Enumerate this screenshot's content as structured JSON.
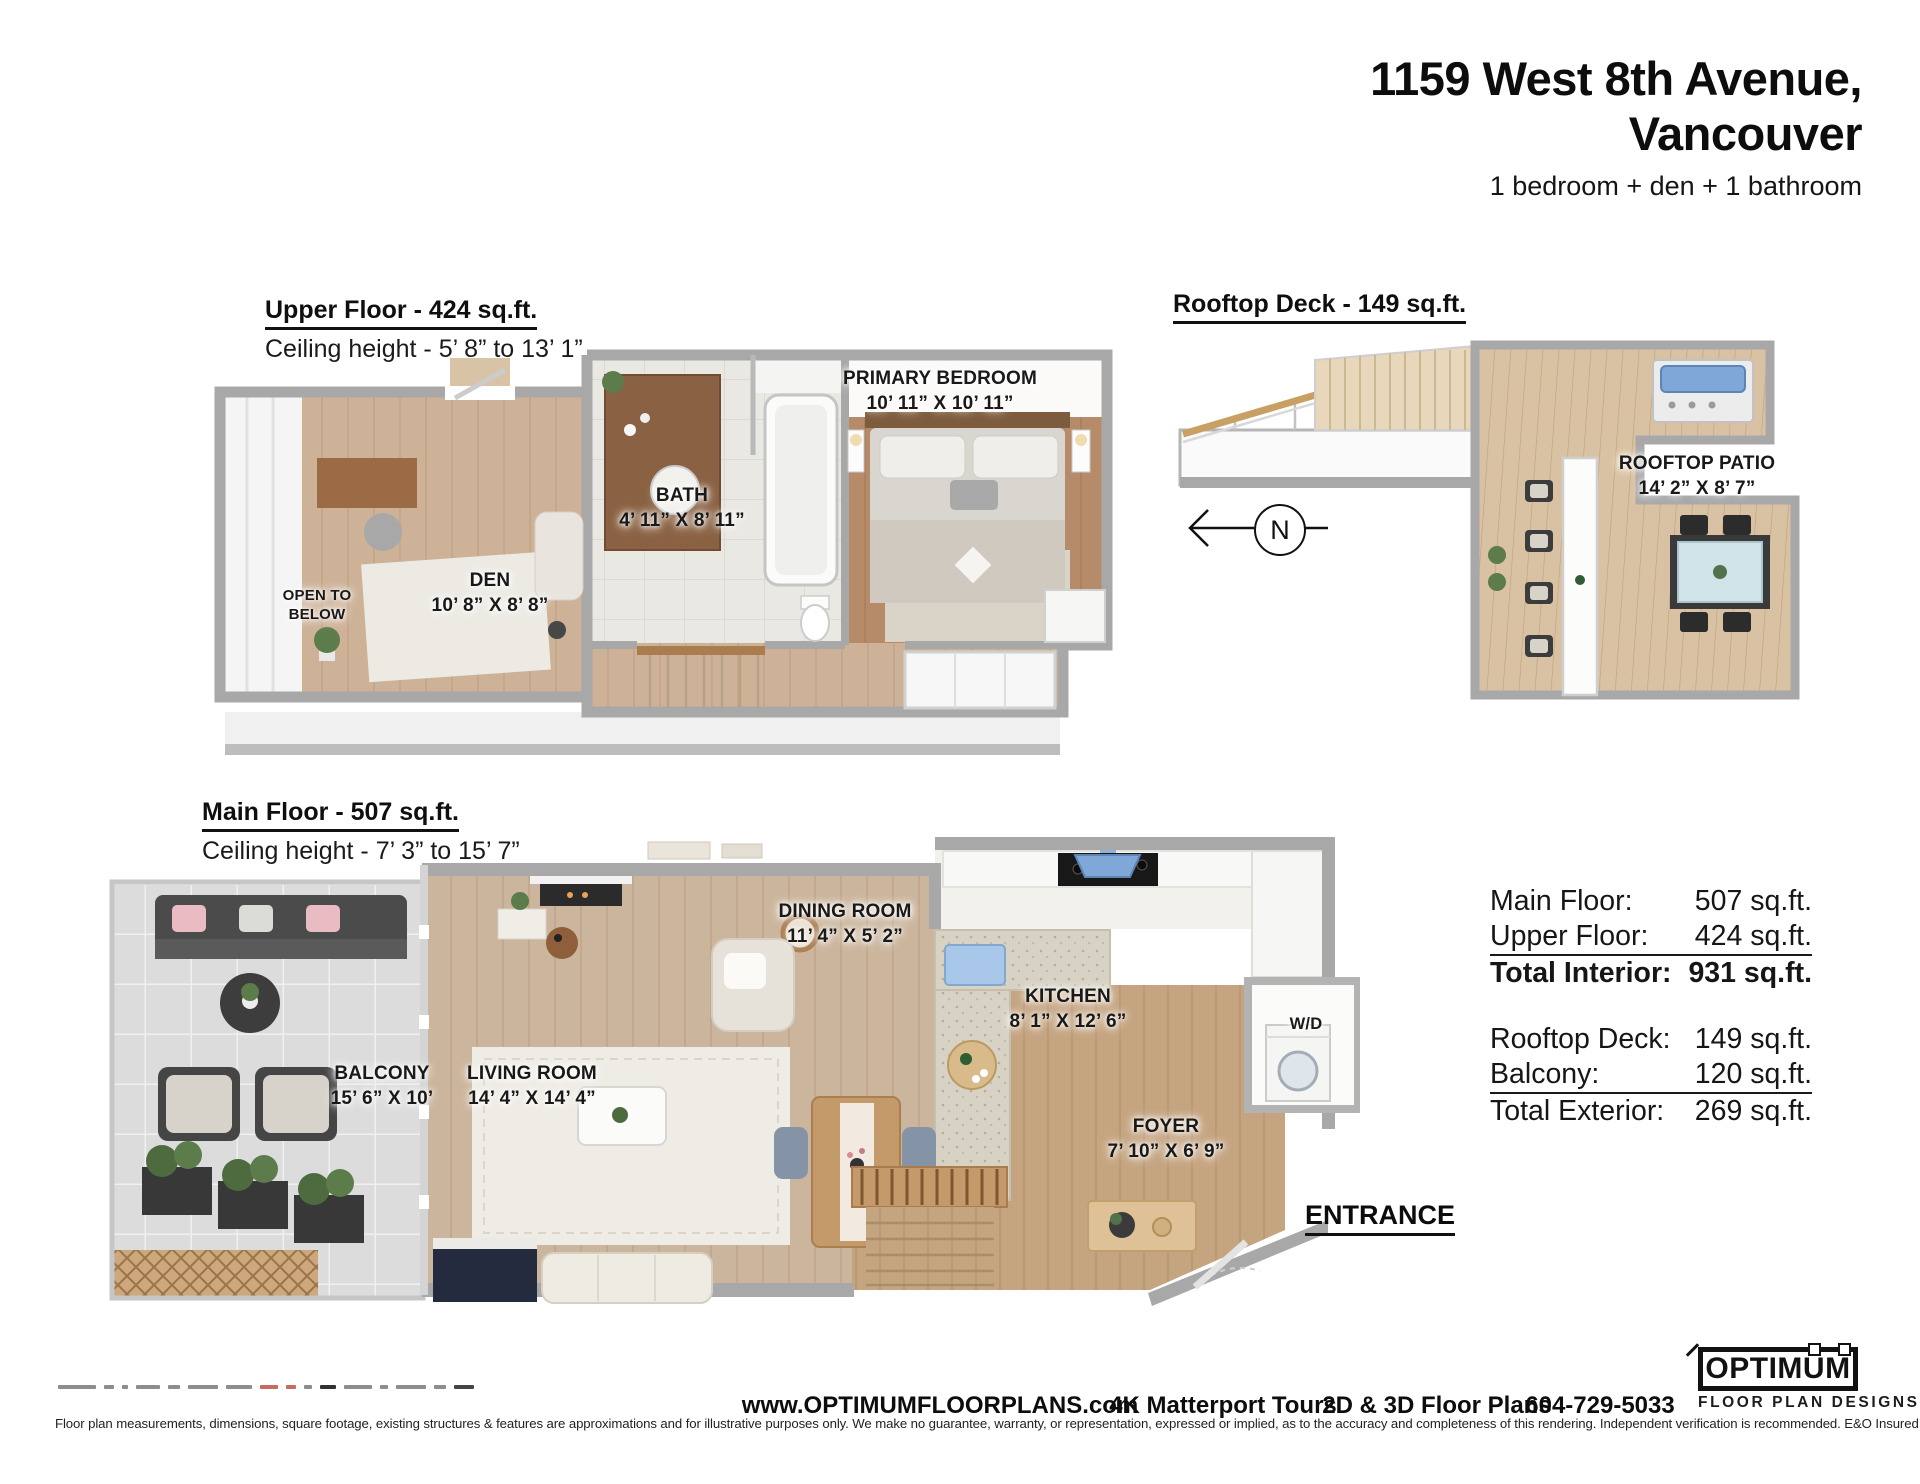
{
  "header": {
    "title_line1": "1159 West 8th Avenue,",
    "title_line2": "Vancouver",
    "subtitle": "1 bedroom + den + 1 bathroom"
  },
  "upper_floor": {
    "heading": "Upper Floor - 424 sq.ft.",
    "ceiling": "Ceiling height - 5’ 8” to 13’ 1”",
    "rooms": {
      "primary_bedroom": {
        "name": "PRIMARY BEDROOM",
        "dims": "10’ 11” X 10’ 11”"
      },
      "bath": {
        "name": "BATH",
        "dims": "4’ 11” X 8’ 11”"
      },
      "den": {
        "name": "DEN",
        "dims": "10’ 8” X 8’ 8”"
      },
      "open_to_below": "OPEN TO BELOW"
    }
  },
  "rooftop": {
    "heading": "Rooftop Deck - 149 sq.ft.",
    "patio": {
      "name": "ROOFTOP PATIO",
      "dims": "14’ 2” X 8’ 7”"
    },
    "compass_letter": "N"
  },
  "main_floor": {
    "heading": "Main Floor - 507 sq.ft.",
    "ceiling": "Ceiling height - 7’ 3” to 15’ 7”",
    "rooms": {
      "dining": {
        "name": "DINING ROOM",
        "dims": "11’ 4” X 5’ 2”"
      },
      "kitchen": {
        "name": "KITCHEN",
        "dims": "8’ 1” X 12’ 6”"
      },
      "balcony": {
        "name": "BALCONY",
        "dims": "15’ 6” X 10’"
      },
      "living": {
        "name": "LIVING ROOM",
        "dims": "14’ 4” X 14’ 4”"
      },
      "foyer": {
        "name": "FOYER",
        "dims": "7’ 10” X 6’ 9”"
      },
      "wd": "W/D"
    },
    "entrance": "ENTRANCE"
  },
  "summary": {
    "interior": [
      {
        "label": "Main Floor:",
        "value": "507 sq.ft."
      },
      {
        "label": "Upper Floor:",
        "value": "424 sq.ft."
      },
      {
        "label": "Total Interior:",
        "value": "931 sq.ft."
      }
    ],
    "exterior": [
      {
        "label": "Rooftop Deck:",
        "value": "149 sq.ft."
      },
      {
        "label": "Balcony:",
        "value": "120 sq.ft."
      },
      {
        "label": "Total Exterior:",
        "value": "269 sq.ft."
      }
    ]
  },
  "footer": {
    "website": "www.OPTIMUMFLOORPLANS.com",
    "service1": "4K Matterport Tours",
    "service2": "2D & 3D Floor Plans",
    "phone": "604-729-5033",
    "disclaimer": "Floor plan measurements, dimensions, square footage, existing structures & features are approximations and for illustrative purposes only. We make no guarantee, warranty, or representation, expressed or implied, as to the accuracy and completeness of this rendering. Independent verification is recommended. E&O Insured for $1,000,000",
    "logo_title": "OPTIMUM",
    "logo_subtitle": "FLOOR PLAN DESIGNS"
  },
  "colors": {
    "wall_gray": "#a8a8a8",
    "wood_light": "#cbb59c",
    "wood_bedroom": "#b68b69",
    "deck_wood": "#d9c2a3",
    "balcony_tile": "#dcdcdc",
    "accent_blue": "#7fa8d9",
    "text": "#111111"
  }
}
